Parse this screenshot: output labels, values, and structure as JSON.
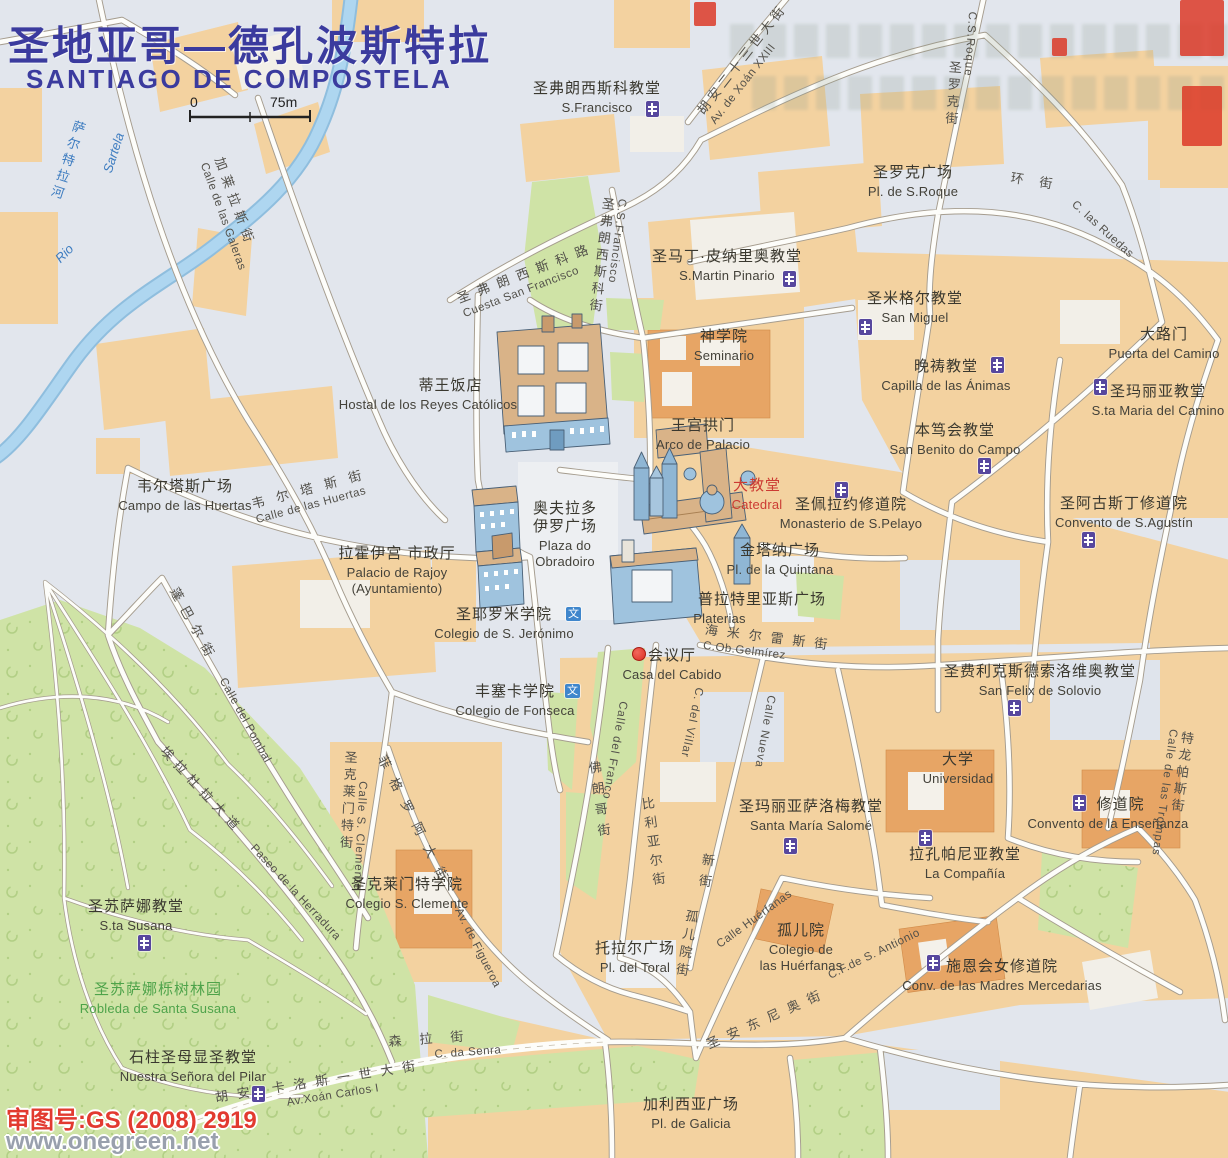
{
  "title": {
    "zh": "圣地亚哥—德孔波斯特拉",
    "en": "SANTIAGO DE COMPOSTELA"
  },
  "scale": {
    "zero": "0",
    "max": "75m"
  },
  "watermark": {
    "line1": "审图号:GS (2008) 2919",
    "line2": "www.onegreen.net"
  },
  "icons": {
    "culture_glyph": "文"
  },
  "colors": {
    "title_blue": "#3b3b9e",
    "catedral_red": "#cc3b33",
    "green_text": "#4ea34a",
    "block_orange": "#f3d2a0",
    "building_orange": "#e7a565",
    "park_green": "#cfe3a6",
    "river_blue": "#aed6f0",
    "church_purple": "#57479e",
    "culture_blue": "#3f86cc",
    "watermark_red": "#e23a30",
    "road_white": "#fdfdfa"
  },
  "river": {
    "zh": "萨尔特拉河",
    "es_rio": "Rio",
    "es_name": "Sartela"
  },
  "pois": {
    "s_francisco": {
      "zh": "圣弗朗西斯科教堂",
      "es": "S.Francisco"
    },
    "s_martin_pinario": {
      "zh": "圣马丁·皮纳里奥教堂",
      "es": "S.Martin Pinario"
    },
    "pl_s_roque": {
      "zh": "圣罗克广场",
      "es": "Pl. de S.Roque"
    },
    "seminario": {
      "zh": "神学院",
      "es": "Seminario"
    },
    "san_miguel": {
      "zh": "圣米格尔教堂",
      "es": "San Miguel"
    },
    "capilla_animas": {
      "zh": "晚祷教堂",
      "es": "Capilla de las Ánimas"
    },
    "puerta_camino": {
      "zh": "大路门",
      "es": "Puerta del Camino"
    },
    "sta_maria_camino": {
      "zh": "圣玛丽亚教堂",
      "es": "S.ta Maria del Camino"
    },
    "san_benito": {
      "zh": "本笃会教堂",
      "es": "San Benito do Campo"
    },
    "arco_palacio": {
      "zh": "王宫拱门",
      "es": "Arco de Palacio"
    },
    "catedral": {
      "zh": "大教堂",
      "es": "Catedral"
    },
    "monasterio_pelayo": {
      "zh": "圣佩拉约修道院",
      "es": "Monasterio de S.Pelayo"
    },
    "pl_quintana": {
      "zh": "金塔纳广场",
      "es": "Pl. de la Quintana"
    },
    "convento_agustin": {
      "zh": "圣阿古斯丁修道院",
      "es": "Convento de S.Agustín"
    },
    "platerias": {
      "zh": "普拉特里亚斯广场",
      "es": "Platerias"
    },
    "hostal": {
      "zh": "蒂王饭店",
      "es": "Hostal de los Reyes Católicos"
    },
    "campo_huertas": {
      "zh": "韦尔塔斯广场",
      "es": "Campo de las Huertas"
    },
    "rajoy": {
      "zh": "拉霍伊宫  市政厅",
      "es": "Palacio de Rajoy",
      "es2": "(Ayuntamiento)"
    },
    "obradoiro": {
      "zh1": "奥夫拉多",
      "zh2": "伊罗广场",
      "es1": "Plaza do",
      "es2": "Obradoiro"
    },
    "col_jeronimo": {
      "zh": "圣耶罗米学院",
      "es": "Colegio de S. Jerónimo"
    },
    "casa_cabido": {
      "zh": "会议厅",
      "es": "Casa del Cabido"
    },
    "col_fonseca": {
      "zh": "丰塞卡学院",
      "es": "Colegio de Fonseca"
    },
    "san_felix": {
      "zh": "圣费利克斯德索洛维奥教堂",
      "es": "San Felix de Solovio"
    },
    "universidad": {
      "zh": "大学",
      "es": "Universidad"
    },
    "convento_ensenanza": {
      "zh": "修道院",
      "es": "Convento de la Enseñanza"
    },
    "sta_maria_salome": {
      "zh": "圣玛丽亚萨洛梅教堂",
      "es": "Santa María Salomé"
    },
    "la_compania": {
      "zh": "拉孔帕尼亚教堂",
      "es": "La Compañía"
    },
    "col_clemente": {
      "zh": "圣克莱门特学院",
      "es": "Colegio S. Clemente"
    },
    "sta_susana": {
      "zh": "圣苏萨娜教堂",
      "es": "S.ta Susana"
    },
    "robleda": {
      "zh": "圣苏萨娜栎树林园",
      "es": "Robleda de Santa Susana"
    },
    "nuestra_pilar": {
      "zh": "石柱圣母显圣教堂",
      "es": "Nuestra Señora del Pilar"
    },
    "pl_toral": {
      "zh": "托拉尔广场",
      "es": "Pl. del Toral"
    },
    "col_huerfanas": {
      "zh": "孤儿院",
      "es1": "Colegio de",
      "es2": "las Huérfanas"
    },
    "conv_mercedarias": {
      "zh": "施恩会女修道院",
      "es": "Conv. de las Madres Mercedarias"
    },
    "pl_galicia": {
      "zh": "加利西亚广场",
      "es": "Pl. de Galicia"
    }
  },
  "streets": {
    "galeras": {
      "zh": "加莱拉斯街",
      "es": "Calle de las Galeras"
    },
    "cuesta_sf": {
      "zh": "圣弗朗西斯科路",
      "es": "Cuesta San Francisco"
    },
    "csf": {
      "zh": "圣弗朗西斯科街",
      "es": "C.S.Francisco"
    },
    "xoan23": {
      "zh": "胡安二十三世大街",
      "es": "Av. de Xoán XXIII"
    },
    "s_roque": {
      "zh": "圣罗克街",
      "es": "C.S.Roque"
    },
    "ring": {
      "zh": "环街",
      "es": "C. las Ruedas"
    },
    "huertas": {
      "zh": "韦尔塔斯街",
      "es": "Calle de las Huertas"
    },
    "pombal": {
      "zh": "蓬巴尔街",
      "es": "Calle del Pombal"
    },
    "herradura": {
      "zh": "埃拉杜拉大道",
      "es": "Paseo de la Herradura"
    },
    "clemente": {
      "zh": "圣克莱门特街",
      "es": "Calle S. Clemente"
    },
    "figueroa": {
      "zh": "菲格罗阿大街",
      "es": "Av. de Figueroa"
    },
    "senra": {
      "zh": "森拉街",
      "es": "C. da Senra"
    },
    "carlos1": {
      "zh": "胡安·卡洛斯一世大街",
      "es": "Av.Xoán Carlos I"
    },
    "franco": {
      "zh": "佛朗哥街",
      "es": "Calle del Franco"
    },
    "villar": {
      "zh": "比利亚尔街",
      "es": "C. del Villar"
    },
    "nueva": {
      "zh": "新街",
      "es": "Calle Nueva"
    },
    "gelmirez": {
      "zh": "海米尔雷斯街",
      "es": "C.Ob.Gelmírez"
    },
    "huerfanas": {
      "zh": "孤儿院街",
      "es": "Calle Huérfanas"
    },
    "antonio": {
      "zh": "圣安东尼奥街",
      "es": "C.F.de S. Antionio"
    },
    "trompas": {
      "zh": "特龙帕斯街",
      "es": "Calle de las Trompas"
    }
  }
}
